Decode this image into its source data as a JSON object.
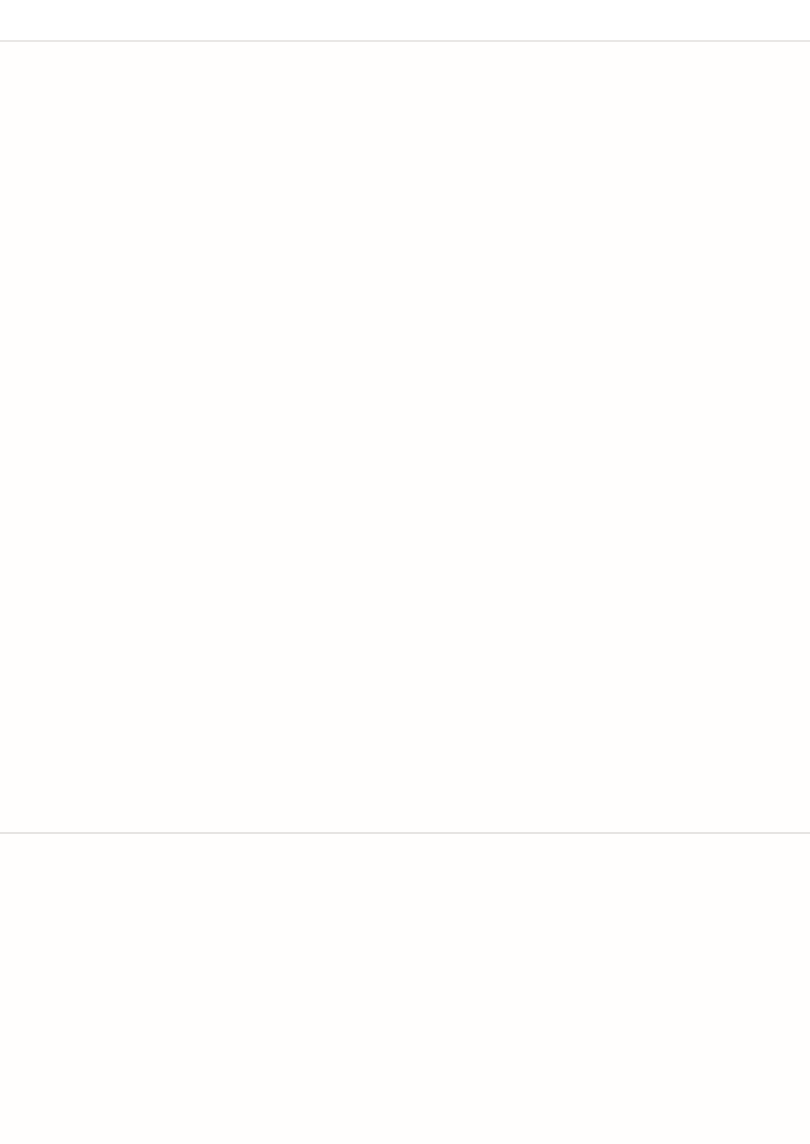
{
  "page": {
    "topbar_color": "#ffffff",
    "background": "#fffefd",
    "divider_color": "#e8e6e4",
    "board_base_color": "#dbc8bb"
  },
  "boards": [
    {
      "name": "board-top",
      "base_rects": [
        {
          "x": 210,
          "y": 104,
          "w": 287,
          "h": 287,
          "r": 16
        }
      ],
      "pieces": [
        {
          "name": "placed-domino-blank-blank-purple",
          "x": 220,
          "y": 113,
          "w": 85,
          "h": 175,
          "fill": "#c9bce9",
          "dash": "#7a50d0",
          "outline": "#33215a",
          "seam": "h-light",
          "pips": []
        },
        {
          "name": "placed-die-4-pink",
          "x": 310,
          "y": 113,
          "w": 85,
          "h": 85,
          "fill": "#f5aec2",
          "dash": "#e6175e",
          "outline": "#3f2033",
          "pip_color": "#6f4757",
          "pips": [
            [
              0.27,
              0.27
            ],
            [
              0.73,
              0.27
            ],
            [
              0.27,
              0.73
            ],
            [
              0.73,
              0.73
            ]
          ]
        },
        {
          "name": "placed-domino-2-2-teal",
          "x": 400,
          "y": 113,
          "w": 85,
          "h": 175,
          "fill": "#abdedc",
          "dash": "#0b8175",
          "outline": "#17403f",
          "seam": "h-dark",
          "pip_color": "#2f5f63",
          "pips": [
            [
              0.27,
              0.15
            ],
            [
              0.74,
              0.36
            ],
            [
              0.74,
              0.65
            ],
            [
              0.31,
              0.87
            ]
          ]
        },
        {
          "name": "empty-hole-cell",
          "x": 310,
          "y": 203,
          "w": 85,
          "h": 85,
          "fill": "#ffffff"
        },
        {
          "name": "placed-die-blank-purple",
          "x": 220,
          "y": 293,
          "w": 85,
          "h": 85,
          "fill": "#c9bce9",
          "dash": "#7a50d0",
          "outline": "#33215a",
          "pips": []
        },
        {
          "name": "placed-domino-4-1-tan",
          "x": 310,
          "y": 293,
          "w": 175,
          "h": 85,
          "fill": "#f3d8a6",
          "dash": "#d9670e",
          "outline": "#463214",
          "seam": "v-dark",
          "pip_color": "#8a6f35",
          "pips": [
            [
              0.14,
              0.28
            ],
            [
              0.36,
              0.28
            ],
            [
              0.14,
              0.72
            ],
            [
              0.36,
              0.72
            ],
            [
              0.75,
              0.5
            ]
          ]
        }
      ],
      "badges": [
        {
          "label": "4",
          "color": "#d4196f",
          "x": 398,
          "y": 208
        },
        {
          "label": "=",
          "color": "#0c7f95",
          "x": 491,
          "y": 301
        },
        {
          "label": "=",
          "color": "#8a45d6",
          "x": 307,
          "y": 388
        },
        {
          "label": "5",
          "color": "#d2610e",
          "x": 488,
          "y": 389
        }
      ]
    },
    {
      "name": "board-middle-left",
      "pieces": [
        {
          "name": "placed-domino-blank-3-navy",
          "x": 32,
          "y": 477,
          "w": 88,
          "h": 178,
          "fill": "#c0cad8",
          "dash": "#1d55a0",
          "outline": "#1b2430",
          "seam": "h-light",
          "pip_color": "#333f4d",
          "pips": [
            [
              0.76,
              0.645
            ],
            [
              0.53,
              0.755
            ],
            [
              0.33,
              0.865
            ]
          ]
        },
        {
          "name": "region-cell-olive-top",
          "x": 215,
          "y": 477,
          "w": 88,
          "h": 88,
          "fill": "#b9ba8e",
          "dash": "#6e7f1c"
        },
        {
          "name": "region-teal-2cells",
          "x": 123,
          "y": 569,
          "w": 180,
          "h": 86,
          "fill": "#a2c9c4",
          "dash": "#128073",
          "seam": "v-light"
        },
        {
          "name": "region-orange-2cells",
          "x": 307,
          "y": 569,
          "w": 180,
          "h": 86,
          "fill": "#f2c391",
          "dash": "#e0660c",
          "seam": "v-light"
        },
        {
          "name": "region-cell-purple-top",
          "x": 399,
          "y": 477,
          "w": 88,
          "h": 88,
          "fill": "#c3add2",
          "dash": "#8a50d8"
        },
        {
          "name": "region-cell-olive-bottom",
          "x": 123,
          "y": 661,
          "w": 88,
          "h": 88,
          "fill": "#b9ba8e",
          "dash": "#6e7f1c"
        },
        {
          "name": "region-cell-purple-bottom",
          "x": 307,
          "y": 661,
          "w": 88,
          "h": 88,
          "fill": "#c3add2",
          "dash": "#8a50d8"
        }
      ],
      "badges": [
        {
          "label": "3",
          "color": "#1b4687",
          "x": 124,
          "y": 662
        },
        {
          "label": "<2",
          "color": "#4c7c0c",
          "x": 309,
          "y": 572
        },
        {
          "label": "4",
          "color": "#0c7f95",
          "x": 309,
          "y": 661
        },
        {
          "label": ">4",
          "color": "#8a45d6",
          "x": 487,
          "y": 572
        },
        {
          "label": "=",
          "color": "#d2610e",
          "x": 489,
          "y": 661
        },
        {
          "label": ">4",
          "color": "#4c7c0c",
          "x": 216,
          "y": 750
        },
        {
          "label": "0",
          "color": "#8a45d6",
          "x": 399,
          "y": 754
        }
      ]
    },
    {
      "name": "board-right",
      "pieces": [
        {
          "name": "region-cell-rose-top",
          "x": 578,
          "y": 477,
          "w": 88,
          "h": 88,
          "fill": "#eda9b6",
          "dash": "#e82560"
        },
        {
          "name": "region-navy-2cells",
          "x": 578,
          "y": 569,
          "w": 88,
          "h": 180,
          "fill": "#a9a6bb",
          "dash": "#1d55a0",
          "seam": "h-light"
        },
        {
          "name": "region-cell-rose-bottom",
          "x": 670,
          "y": 661,
          "w": 88,
          "h": 88,
          "fill": "#eda9b6",
          "dash": "#e82560"
        }
      ],
      "badges": [
        {
          "label": ">0",
          "color": "#d4196f",
          "x": 670,
          "y": 572
        },
        {
          "label": "=",
          "color": "#1b4687",
          "x": 668,
          "y": 754
        },
        {
          "label": ">4",
          "color": "#d4196f",
          "x": 762,
          "y": 755
        }
      ]
    }
  ],
  "tray": {
    "slot_color": "#f6eeea",
    "rows": [
      {
        "items": [
          {
            "type": "domino",
            "x": 123,
            "y": 870,
            "w": 130,
            "h": 67,
            "halves": [
              5,
              6
            ]
          },
          {
            "type": "domino",
            "x": 271,
            "y": 870,
            "w": 130,
            "h": 67,
            "halves": [
              1,
              0
            ]
          },
          {
            "type": "domino",
            "x": 417,
            "y": 870,
            "w": 130,
            "h": 67,
            "halves": [
              5,
              3
            ]
          },
          {
            "type": "domino",
            "x": 564,
            "y": 870,
            "w": 130,
            "h": 67,
            "halves": [
              0,
              5
            ]
          }
        ]
      },
      {
        "items": [
          {
            "type": "slot",
            "x": 124,
            "y": 953,
            "w": 128,
            "h": 63
          },
          {
            "type": "slot",
            "x": 272,
            "y": 953,
            "w": 128,
            "h": 63
          },
          {
            "type": "domino",
            "x": 415,
            "y": 951,
            "w": 130,
            "h": 66,
            "halves": [
              4,
              1
            ]
          },
          {
            "type": "domino",
            "x": 563,
            "y": 951,
            "w": 130,
            "h": 66,
            "halves": [
              6,
              4
            ]
          }
        ]
      },
      {
        "items": [
          {
            "type": "slot",
            "x": 200,
            "y": 1037,
            "w": 127,
            "h": 59
          },
          {
            "type": "slot",
            "x": 347,
            "y": 1037,
            "w": 127,
            "h": 59
          },
          {
            "type": "slot",
            "x": 494,
            "y": 1037,
            "w": 127,
            "h": 59
          }
        ]
      }
    ]
  }
}
